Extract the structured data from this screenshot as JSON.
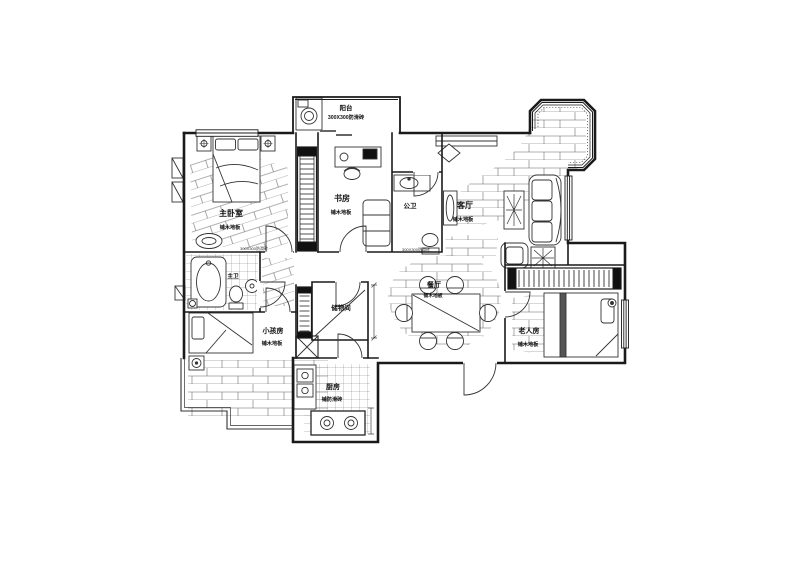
{
  "title": "apartment-floor-plan",
  "colors": {
    "ink": "#1a1a1a",
    "furniture": "#333333",
    "hatch": "#5a5a5a",
    "paper": "#ffffff"
  },
  "rooms": [
    {
      "id": "balcony",
      "name": "阳台",
      "sub": "300X300防滑砖"
    },
    {
      "id": "master-bedroom",
      "name": "主卧室",
      "sub": "铺木地板"
    },
    {
      "id": "study",
      "name": "书房",
      "sub": "铺木地板"
    },
    {
      "id": "public-bath",
      "name": "公卫",
      "sub": "300X300防滑砖"
    },
    {
      "id": "living-room",
      "name": "客厅",
      "sub": "铺木地板"
    },
    {
      "id": "dining-room",
      "name": "餐厅",
      "sub": "铺木地板"
    },
    {
      "id": "master-bath",
      "name": "主卫",
      "sub": "300X300防滑砖"
    },
    {
      "id": "kids-room",
      "name": "小孩房",
      "sub": "铺木地板"
    },
    {
      "id": "storage",
      "name": "储物间",
      "sub": ""
    },
    {
      "id": "kitchen",
      "name": "厨房",
      "sub": "铺防滑砖"
    },
    {
      "id": "elder-room",
      "name": "老人房",
      "sub": "铺木地板"
    }
  ]
}
